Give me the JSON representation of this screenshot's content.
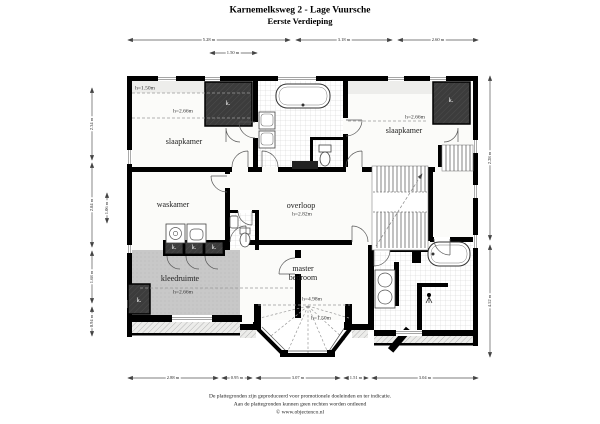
{
  "title": {
    "line1": "Karnemelksweg 2 - Lage Vuursche",
    "line2": "Eerste Verdieping"
  },
  "labels": {
    "closet": "k."
  },
  "rooms": {
    "slaapkamer_left": {
      "name": "slaapkamer",
      "ceiling": "h=2.66m",
      "low_ceiling": "h=1.50m"
    },
    "slaapkamer_right": {
      "name": "slaapkamer",
      "ceiling": "h=2.66m"
    },
    "waskamer": {
      "name": "waskamer"
    },
    "overloop": {
      "name": "overloop",
      "ceiling": "h=2.82m"
    },
    "kleedruimte": {
      "name": "kleedruimte",
      "ceiling": "h=2.66m",
      "low_ceiling": "h=1.50m"
    },
    "master_bedroom": {
      "name": "master\nbedroom",
      "ceiling": "h=4.98m"
    }
  },
  "dimensions": {
    "top": [
      "5.28 m",
      "3.18 m",
      "2.60 m"
    ],
    "top_inner": "1.50 m",
    "bottom": [
      "2.88 m",
      "0.95 m",
      "3.07 m",
      "1.51 m",
      "3.04 m"
    ],
    "left": [
      "2.34 m",
      "2.84 m",
      "1.68 m",
      "0.94 m"
    ],
    "left_inner": "1.06 m",
    "right": [
      "2.28 m",
      "4.52 m"
    ]
  },
  "footer": {
    "line1": "De plattegronden zijn geproduceerd voor promotionele doeleinden en ter indicatie.",
    "line2": "Aan de plattegronden kunnen geen rechten worden ontleend",
    "line3": "© www.objectenco.nl"
  },
  "colors": {
    "wall": "#000000",
    "closet_fill": "#3c3c3c",
    "dressing_floor": "#c8c8c8",
    "tile_line": "#d0d0d0",
    "dim_line": "#555555"
  }
}
